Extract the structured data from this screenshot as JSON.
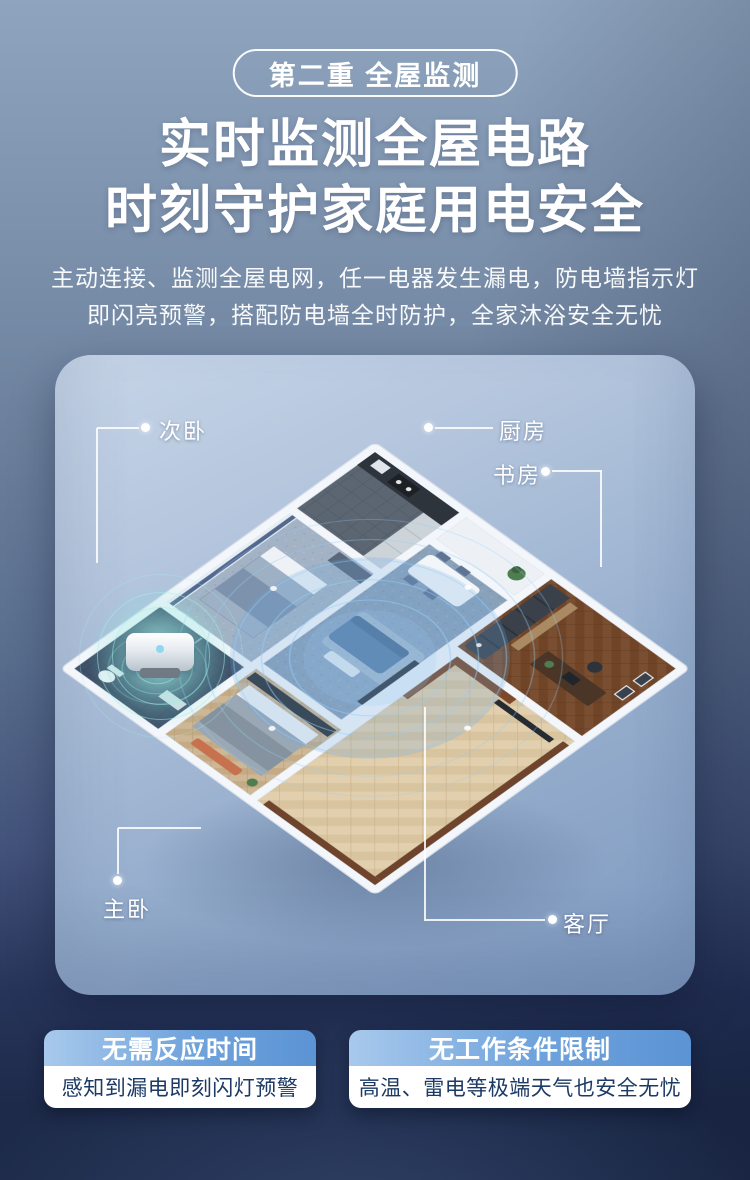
{
  "badge": {
    "label": "第二重 全屋监测"
  },
  "title": {
    "line1": "实时监测全屋电路",
    "line2": "时刻守护家庭用电安全"
  },
  "subtitle": {
    "line1": "主动连接、监测全屋电网，任一电器发生漏电，防电墙指示灯",
    "line2": "即闪亮预警，搭配防电墙全时防护，全家沐浴安全无忧"
  },
  "floorplan": {
    "rooms": [
      {
        "id": "secondary-bedroom",
        "label": "次卧"
      },
      {
        "id": "kitchen",
        "label": "厨房"
      },
      {
        "id": "study",
        "label": "书房"
      },
      {
        "id": "master-bedroom",
        "label": "主卧"
      },
      {
        "id": "living-room",
        "label": "客厅"
      }
    ],
    "device": "water-heater"
  },
  "features": [
    {
      "title": "无需反应时间",
      "desc": "感知到漏电即刻闪灯预警"
    },
    {
      "title": "无工作条件限制",
      "desc": "高温、雷电等极端天气也安全无忧"
    }
  ],
  "colors": {
    "page_top": "#8fa4be",
    "page_bottom": "#1d2a49",
    "card_top": "#c7d5e7",
    "card_bottom": "#7f9ac0",
    "feature_header_from": "#a8c9ec",
    "feature_header_to": "#5b93d4",
    "feature_text": "#1c3a66",
    "ripple": "#9fd4ef",
    "device_glow": "#8ee8e0"
  }
}
